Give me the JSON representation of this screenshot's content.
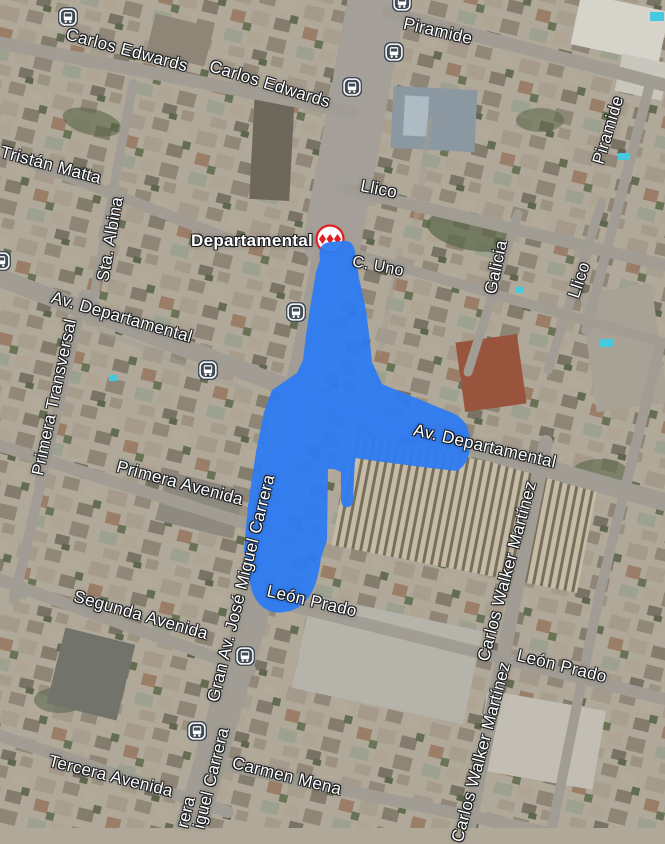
{
  "map": {
    "view_type": "satellite",
    "colors": {
      "highlight_blue": "#2e7bf2",
      "metro_red": "#df1f26",
      "bus_icon_bg": "#3f4a54",
      "label_text": "#ffffff"
    },
    "station": {
      "name": "Departamental",
      "kind": "metro-station",
      "x": 330,
      "y": 239
    },
    "street_labels": [
      {
        "text": "Carlos Edwards",
        "x": 127,
        "y": 50,
        "rot": 15,
        "size": 17
      },
      {
        "text": "Carlos Edwards",
        "x": 270,
        "y": 84,
        "rot": 17,
        "size": 17
      },
      {
        "text": "Piramide",
        "x": 438,
        "y": 31,
        "rot": 13,
        "size": 17
      },
      {
        "text": "Tristán Matta",
        "x": 51,
        "y": 165,
        "rot": 15,
        "size": 17
      },
      {
        "text": "Llico",
        "x": 379,
        "y": 189,
        "rot": 11,
        "size": 17
      },
      {
        "text": "Sta. Albina",
        "x": 110,
        "y": 239,
        "rot": -80,
        "size": 17
      },
      {
        "text": "C. Uno",
        "x": 378,
        "y": 267,
        "rot": 11,
        "size": 16
      },
      {
        "text": "Galicia",
        "x": 496,
        "y": 267,
        "rot": -78,
        "size": 17
      },
      {
        "text": "Llico",
        "x": 579,
        "y": 280,
        "rot": -72,
        "size": 17
      },
      {
        "text": "Piramide",
        "x": 608,
        "y": 130,
        "rot": -73,
        "size": 17
      },
      {
        "text": "Av. Departamental",
        "x": 122,
        "y": 317,
        "rot": 16,
        "size": 17
      },
      {
        "text": "Primera Transversal",
        "x": 54,
        "y": 397,
        "rot": -78,
        "size": 17
      },
      {
        "text": "Primera Avenida",
        "x": 180,
        "y": 483,
        "rot": 15,
        "size": 17
      },
      {
        "text": "Av. Departamental",
        "x": 485,
        "y": 446,
        "rot": 13,
        "size": 17
      },
      {
        "text": "Gran Av. José Miguel Carrera",
        "x": 241,
        "y": 588,
        "rot": -76,
        "size": 17
      },
      {
        "text": "León Prado",
        "x": 312,
        "y": 601,
        "rot": 13,
        "size": 17
      },
      {
        "text": "Segunda Avenida",
        "x": 141,
        "y": 615,
        "rot": 16,
        "size": 17
      },
      {
        "text": "Carlos Walker Martínez",
        "x": 507,
        "y": 571,
        "rot": -75,
        "size": 17
      },
      {
        "text": "León Prado",
        "x": 562,
        "y": 666,
        "rot": 14,
        "size": 17
      },
      {
        "text": "Carmen Mena",
        "x": 287,
        "y": 776,
        "rot": 14,
        "size": 17
      },
      {
        "text": "Tercera Avenida",
        "x": 111,
        "y": 776,
        "rot": 14,
        "size": 17
      },
      {
        "text": "Carlos Walker Martínez",
        "x": 481,
        "y": 752,
        "rot": -75,
        "size": 17
      },
      {
        "text": "iguel Carrera",
        "x": 211,
        "y": 778,
        "rot": -76,
        "size": 17
      },
      {
        "text": "rera",
        "x": 186,
        "y": 812,
        "rot": -76,
        "size": 17
      }
    ],
    "bus_stops": [
      {
        "x": 68,
        "y": 17
      },
      {
        "x": 402,
        "y": 2
      },
      {
        "x": 394,
        "y": 52
      },
      {
        "x": 352,
        "y": 87
      },
      {
        "x": 1,
        "y": 261
      },
      {
        "x": 208,
        "y": 370
      },
      {
        "x": 296,
        "y": 312
      },
      {
        "x": 245,
        "y": 656
      },
      {
        "x": 197,
        "y": 731
      }
    ]
  }
}
